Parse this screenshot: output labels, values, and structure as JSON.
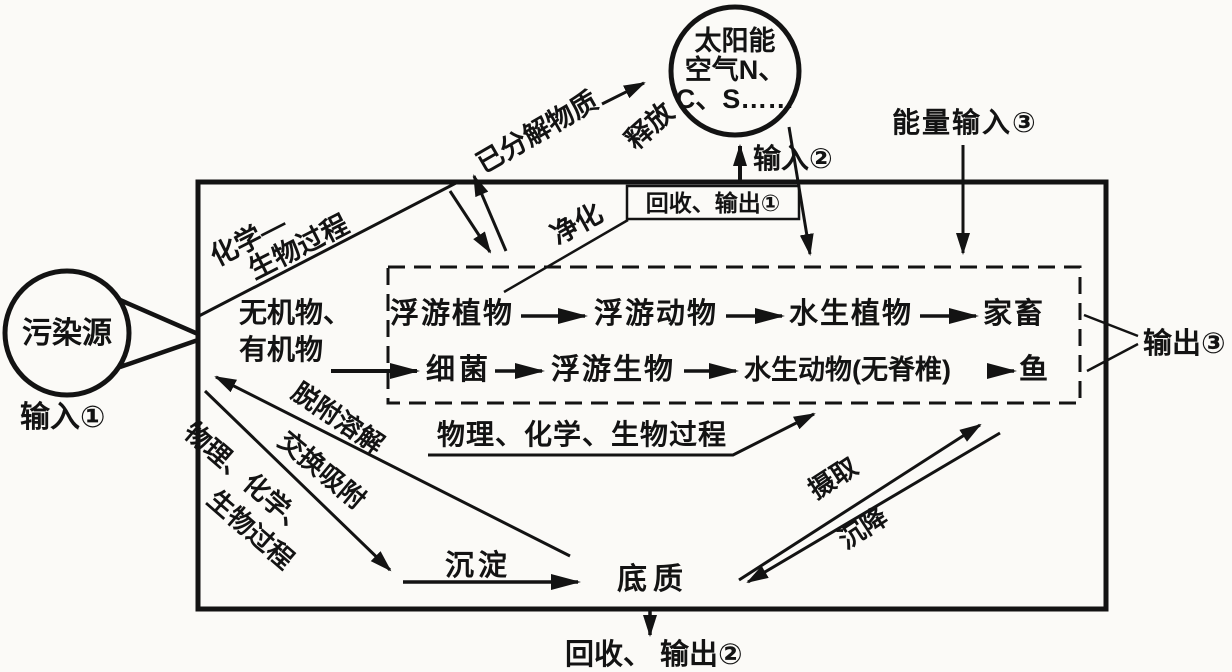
{
  "colors": {
    "ink": "#131313",
    "paper": "#fbfaf7"
  },
  "labels": {
    "sun_circle_line1": "太阳能",
    "sun_circle_line2": "空气N、",
    "sun_circle_line3": "C、S……",
    "pollution_source": "污染源",
    "input1": "输入①",
    "input2": "输入②",
    "energy_input3": "能量输入③",
    "recycle_output1": "回收、输出①",
    "recycle_output2": "回收、 输出②",
    "output3": "输出③",
    "release": "释放",
    "decomposed_matter": "已分解物质",
    "chem_bio_line1": "化学—",
    "chem_bio_line2": "生物过程",
    "purification": "净化",
    "inorganic": "无机物、",
    "organic": "有机物",
    "desorption": "脱附溶解",
    "exchange_adsorption": "交换吸附",
    "phys_chem_bio_left_line1": "物理、化学、",
    "phys_chem_bio_left_line2": "生物过程",
    "phys_chem_bio_mid": "物理、化学、生物过程",
    "sedimentation": "沉淀",
    "sediment": "底质",
    "uptake": "摄取",
    "settling": "沉降"
  },
  "food_chain": {
    "row1": [
      "浮游植物",
      "浮游动物",
      "水生植物",
      "家畜"
    ],
    "row2": [
      "细菌",
      "浮游生物",
      "水生动物(无脊椎)",
      "鱼"
    ]
  }
}
